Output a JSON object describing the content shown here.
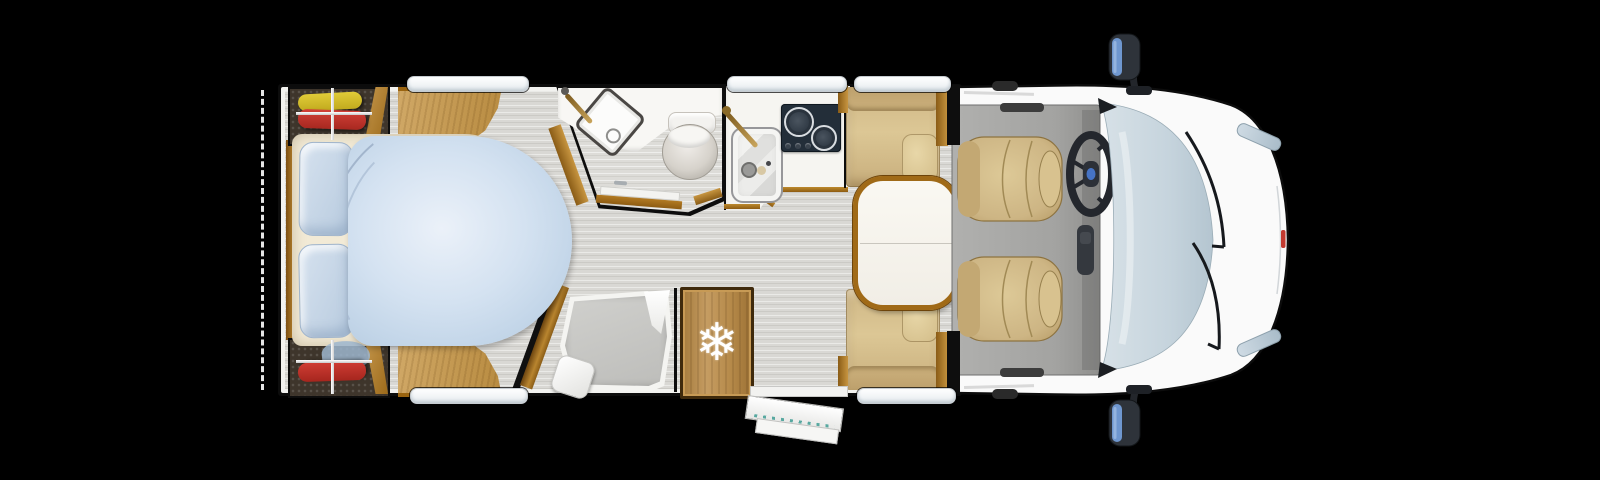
{
  "meta": {
    "description": "Top-down motorhome floor plan render on a black background",
    "canvas": {
      "width": 1600,
      "height": 480
    }
  },
  "icons": {
    "snowflake": "❄"
  },
  "colors": {
    "background": "#000000",
    "outline_black": "#0d0d0d",
    "wall_white": "#f2f2ef",
    "floor_grey": "#d9d8d4",
    "wood_trim": "#a9731f",
    "wood_panel": "#c89f5d",
    "wood_dark": "#8a5c16",
    "upholstery_tan": "#d4be8c",
    "cab_seat_tan": "#cdb584",
    "table_white": "#f8f6f0",
    "bedding_blue": "#cddcec",
    "pillow_blue": "#c4d5e8",
    "mattress_cream": "#f2ead6",
    "windshield_blue": "#c9d7e0",
    "cab_floor_grey": "#a3a3a1",
    "hob_dark": "#232e39",
    "fridge_wood": "#b28748",
    "garment_yellow": "#d8c22e",
    "garment_red": "#c5342c",
    "garment_blue": "#9db6cf",
    "mirror_glass_blue": "#6f97cf",
    "step_tread_teal": "#58a8a0",
    "badge_red": "#c23a30"
  }
}
